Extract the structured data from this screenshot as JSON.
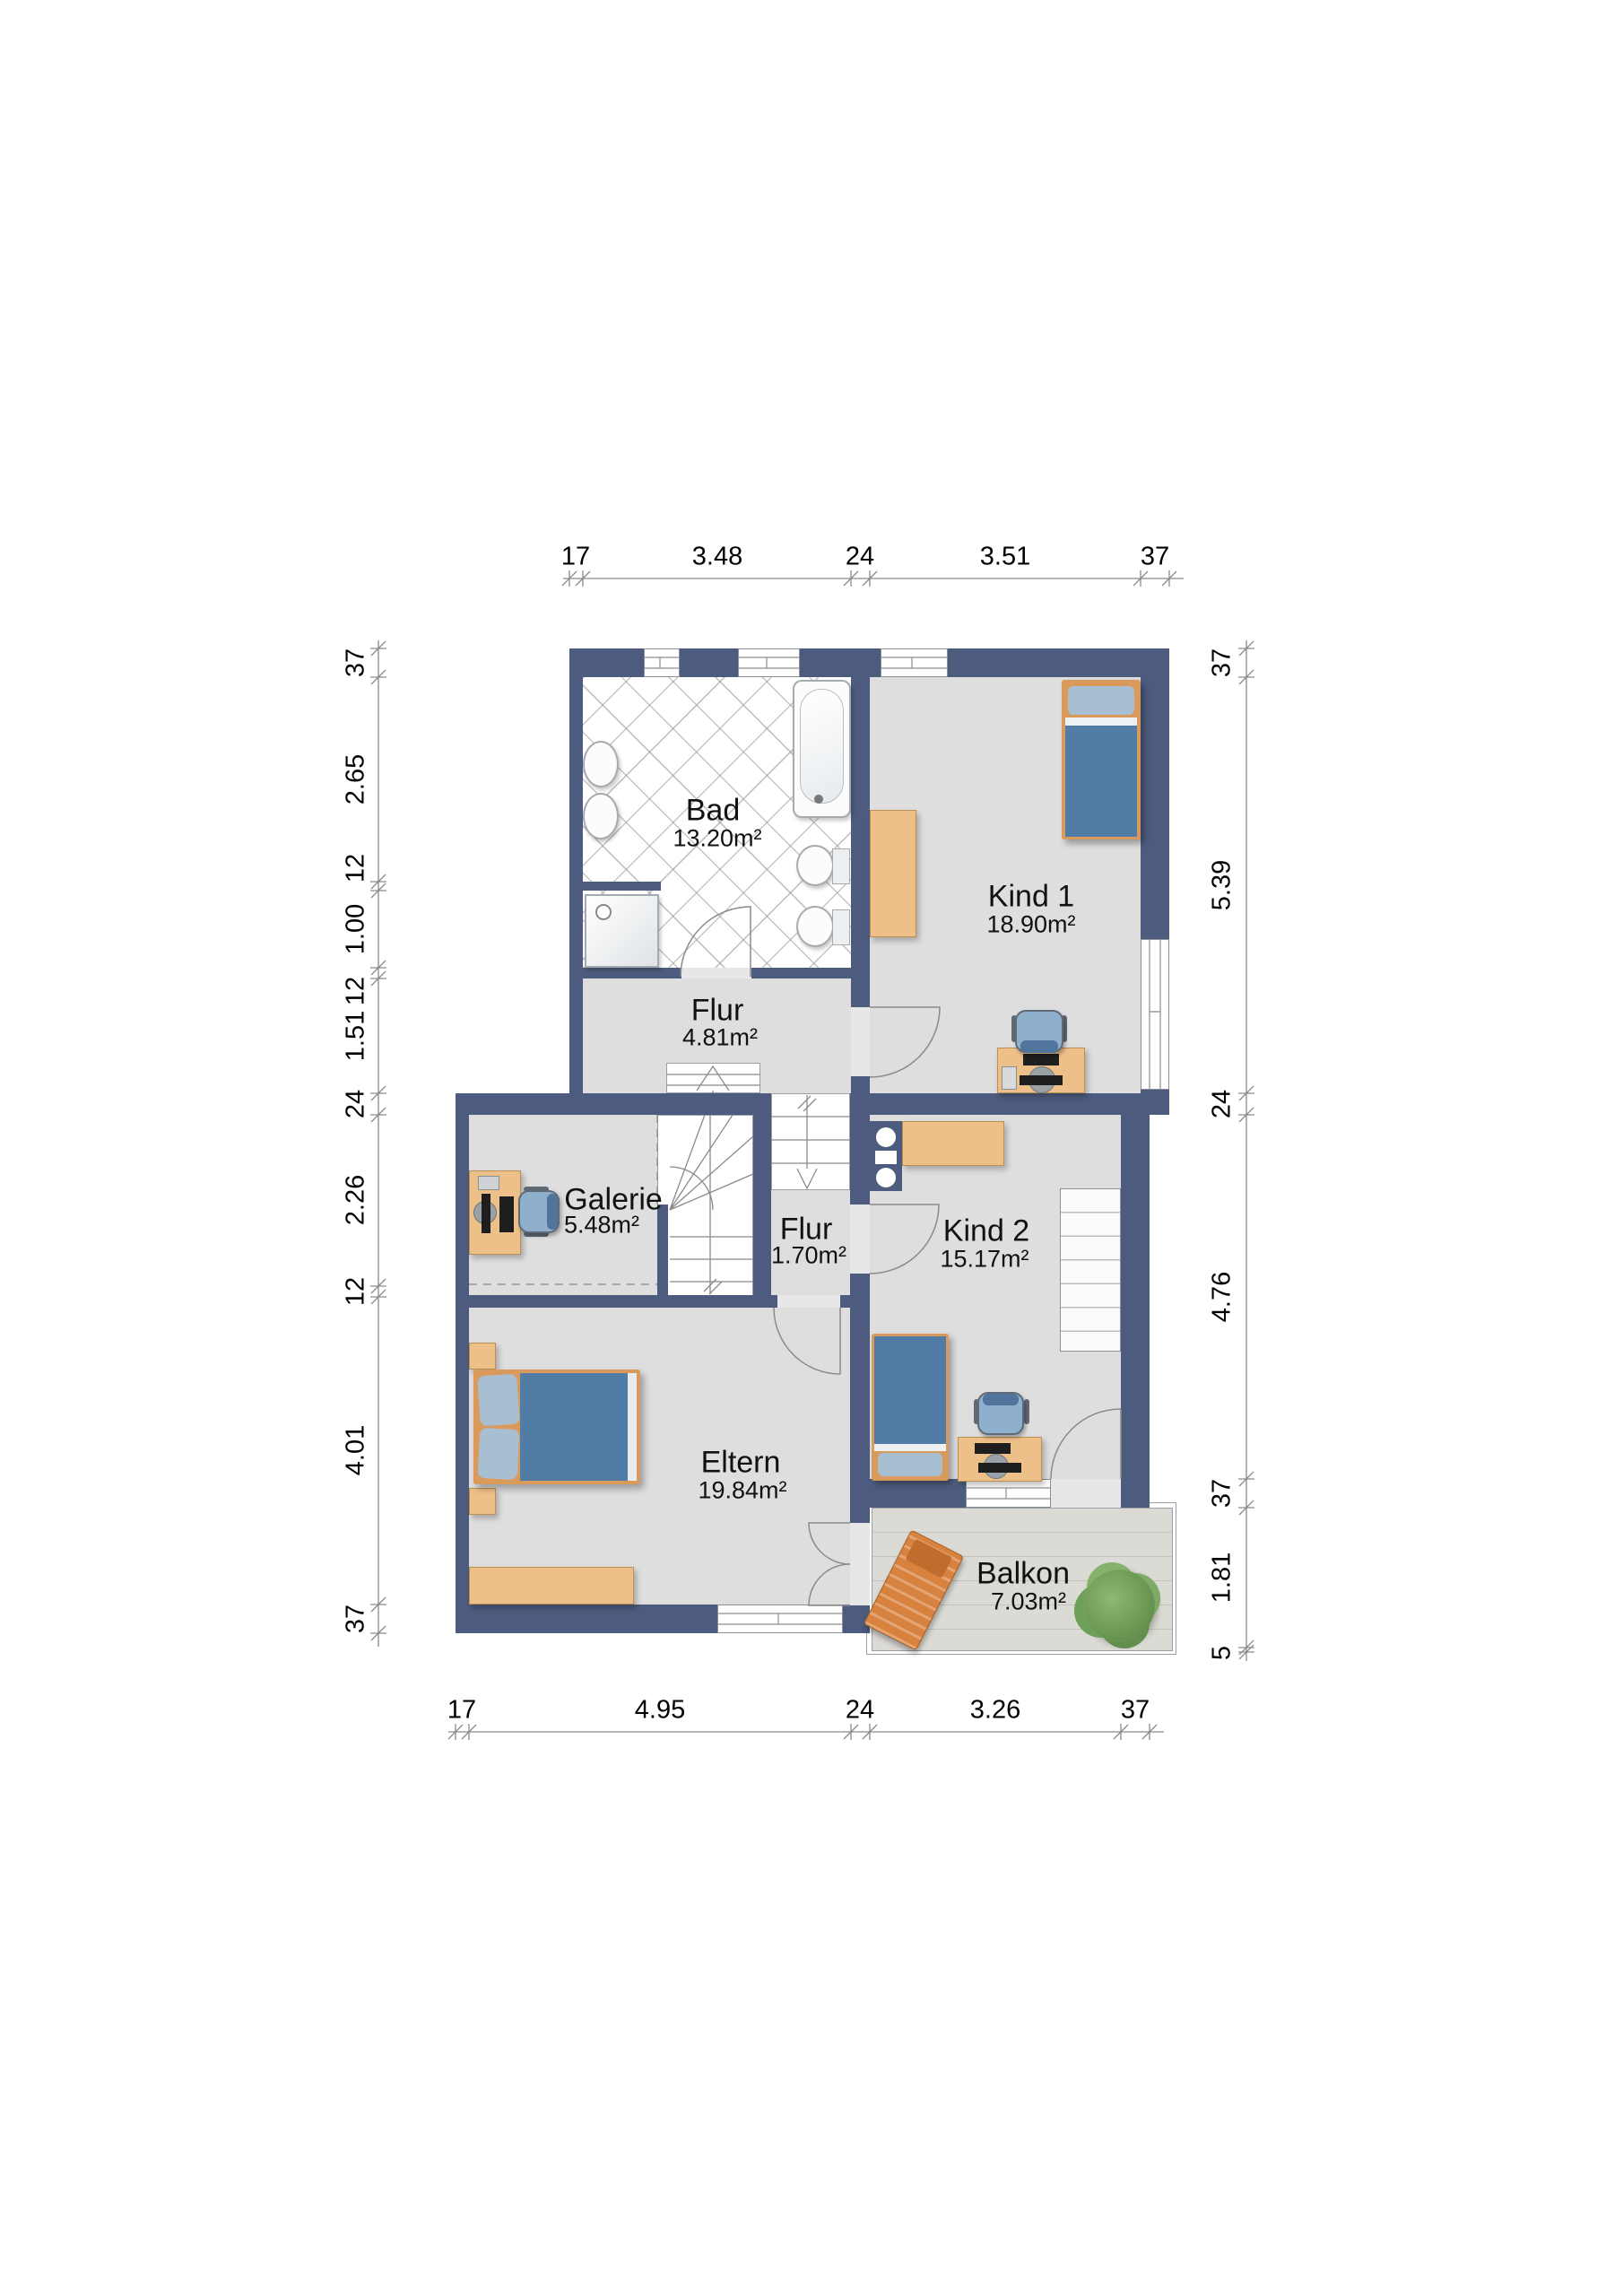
{
  "rooms": {
    "bad": {
      "name": "Bad",
      "area": "13.20m²"
    },
    "kind1": {
      "name": "Kind 1",
      "area": "18.90m²"
    },
    "flur": {
      "name": "Flur",
      "area": "4.81m²"
    },
    "galerie": {
      "name": "Galerie",
      "area": "5.48m²"
    },
    "flur2": {
      "name": "Flur",
      "area": "1.70m²"
    },
    "kind2": {
      "name": "Kind 2",
      "area": "15.17m²"
    },
    "eltern": {
      "name": "Eltern",
      "area": "19.84m²"
    },
    "balkon": {
      "name": "Balkon",
      "area": "7.03m²"
    }
  },
  "dimensions": {
    "top": [
      "17",
      "3.48",
      "24",
      "3.51",
      "37"
    ],
    "bottom": [
      "17",
      "4.95",
      "24",
      "3.26",
      "37"
    ],
    "left": [
      "37",
      "2.65",
      "12",
      "1.00",
      "12",
      "1.51",
      "24",
      "2.26",
      "12",
      "4.01",
      "37"
    ],
    "right": [
      "37",
      "5.39",
      "24",
      "4.76",
      "37",
      "1.81",
      "5"
    ]
  },
  "colors": {
    "wall": "#4d5c7e",
    "floor": "#dedede",
    "deck": "#dbdad5",
    "wood": "#eec089",
    "woodDark": "#d99a5c",
    "fabric": "#517ca6",
    "fabricLight": "#a8bfd2",
    "line": "#8a8a8a"
  }
}
